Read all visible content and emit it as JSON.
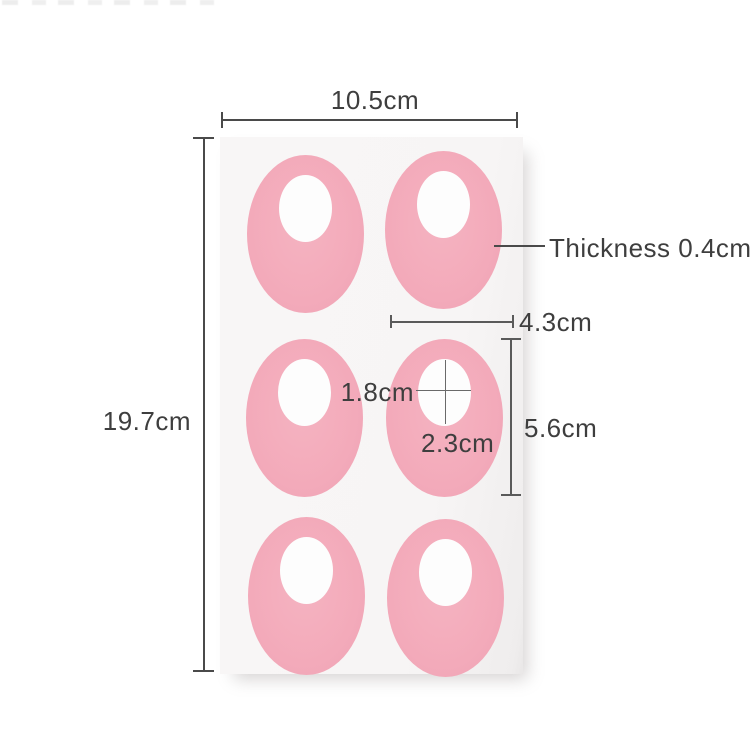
{
  "figure": {
    "kind": "product-dimension-diagram",
    "grid": {
      "rows": 3,
      "cols": 2,
      "pad_count": 6
    },
    "labels": {
      "sheet_width": "10.5cm",
      "sheet_height": "19.7cm",
      "thickness": "Thickness 0.4cm",
      "pad_width": "4.3cm",
      "pad_height": "5.6cm",
      "hole_width": "1.8cm",
      "hole_height": "2.3cm"
    }
  },
  "colors": {
    "background": "#ffffff",
    "sheet": "#f8f6f6",
    "pad_pink": "#f3aaba",
    "hole": "#fdfdfd",
    "line": "#4a4a4a",
    "text": "#3e3e3e"
  }
}
